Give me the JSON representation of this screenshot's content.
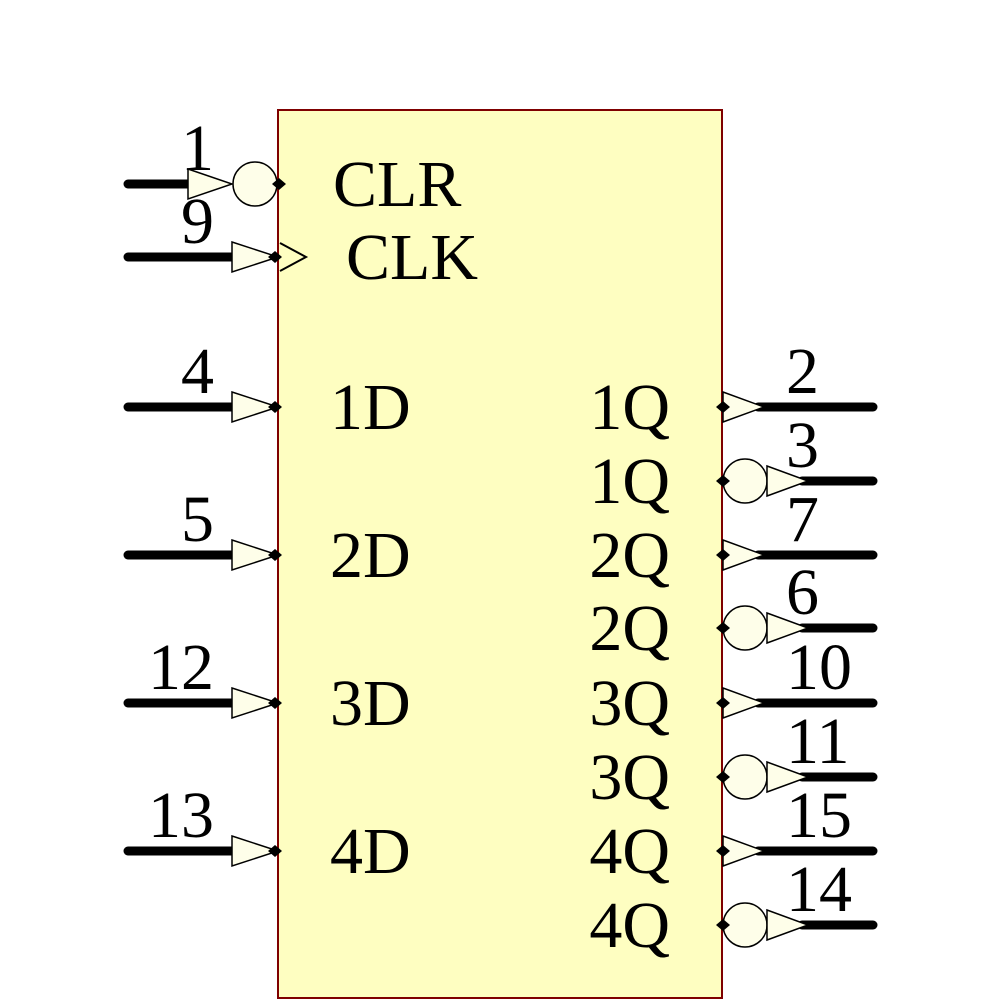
{
  "figure": {
    "background": "#FFFFFF",
    "component": {
      "kind": "quad-d-flip-flop-symbol",
      "body": {
        "x": 278,
        "y": 110,
        "width": 444,
        "height": 888,
        "fill": "#FEFEC1",
        "border_color": "#7F0000",
        "border_width": 2
      },
      "style": {
        "wire_color": "#000000",
        "wire_width": 9,
        "pin_symbol_fill": "#FEFEE9",
        "pin_symbol_outline": "#000000",
        "text_color": "#000000",
        "bubble_radius": 22
      },
      "left_pins": [
        {
          "number": "1",
          "label": "CLR",
          "y": 184,
          "bubble": true,
          "clock": false
        },
        {
          "number": "9",
          "label": "CLK",
          "y": 257,
          "bubble": false,
          "clock": true
        },
        {
          "number": "4",
          "label": "1D",
          "y": 407,
          "bubble": false,
          "clock": false
        },
        {
          "number": "5",
          "label": "2D",
          "y": 555,
          "bubble": false,
          "clock": false
        },
        {
          "number": "12",
          "label": "3D",
          "y": 703,
          "bubble": false,
          "clock": false
        },
        {
          "number": "13",
          "label": "4D",
          "y": 851,
          "bubble": false,
          "clock": false
        }
      ],
      "right_pins": [
        {
          "number": "2",
          "label": "1Q",
          "y": 407,
          "bubble": false
        },
        {
          "number": "3",
          "label": "1Q",
          "y": 481,
          "bubble": true
        },
        {
          "number": "7",
          "label": "2Q",
          "y": 555,
          "bubble": false
        },
        {
          "number": "6",
          "label": "2Q",
          "y": 628,
          "bubble": true
        },
        {
          "number": "10",
          "label": "3Q",
          "y": 703,
          "bubble": false
        },
        {
          "number": "11",
          "label": "3Q",
          "y": 777,
          "bubble": true
        },
        {
          "number": "15",
          "label": "4Q",
          "y": 851,
          "bubble": false
        },
        {
          "number": "14",
          "label": "4Q",
          "y": 925,
          "bubble": true
        }
      ],
      "geometry": {
        "wire_left_x": 128,
        "wire_right_x": 873,
        "arrow_length": 45,
        "arrow_half_height": 15,
        "number_right_align_x": 214,
        "number_left_align_x": 786,
        "label_left_x": 330,
        "label_left_x_clr": 333,
        "label_left_x_clk": 346,
        "label_right_x": 670,
        "number_baseline_offset": 14,
        "label_baseline_offset": 22,
        "clock_depth": 28,
        "clock_half_height": 14
      }
    }
  }
}
